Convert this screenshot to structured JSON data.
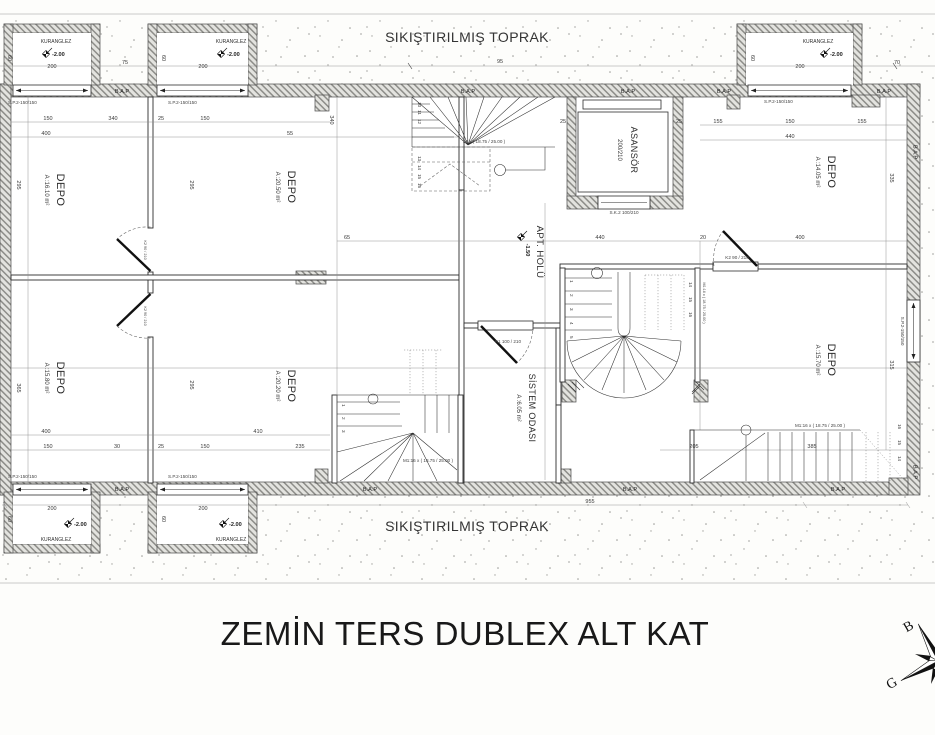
{
  "title": "ZEMİN TERS DUBLEX ALT KAT",
  "soil": {
    "top": "SIKIŞTIRILMIŞ TOPRAK",
    "bottom": "SIKIŞTIRILMIŞ TOPRAK"
  },
  "rooms": {
    "depo1": {
      "name": "DEPO",
      "area": "A :16.10 m²"
    },
    "depo2": {
      "name": "DEPO",
      "area": "A :20.50 m²"
    },
    "depo3": {
      "name": "DEPO",
      "area": "A :14.05 m²"
    },
    "depo4": {
      "name": "DEPO",
      "area": "A :15.80 m²"
    },
    "depo5": {
      "name": "DEPO",
      "area": "A :20.20 m²"
    },
    "depo6": {
      "name": "DEPO",
      "area": "A :15.70 m²"
    },
    "hall": {
      "name": "APT. HOLÜ",
      "level": "-1.50"
    },
    "sistem": {
      "name": "SİSTEM ODASI",
      "area": "A :6.05 m²"
    },
    "asansor": {
      "name": "ASANSÖR",
      "size": "200/210"
    }
  },
  "lightwell": {
    "label": "KURANGLEZ",
    "level": "-2.00"
  },
  "labels": {
    "bap": "B.A.P",
    "window": "S.P.2-150/150",
    "door_k1": "K1 100 / 210",
    "door_k2": "K2 90 / 210",
    "door_sk2": "S.K.2 100/210",
    "stair": "M1:16 x ( 18.75 / 25.00 )",
    "stair_short": "16 x ( 18.75 / 25.00 )"
  },
  "compass": {
    "west": "B",
    "south": "G"
  },
  "dims": [
    "95",
    "150",
    "340",
    "25",
    "150",
    "155",
    "150",
    "155",
    "400",
    "55",
    "440",
    "295",
    "365",
    "335",
    "315",
    "295",
    "295",
    "65",
    "440",
    "20",
    "400",
    "400",
    "410",
    "150",
    "30",
    "25",
    "150",
    "235",
    "205",
    "385",
    "955",
    "200",
    "75",
    "200",
    "200",
    "70",
    "60",
    "60",
    "60",
    "200",
    "200",
    "60",
    "60",
    "25",
    "25",
    "340"
  ],
  "treads": {
    "s1": [
      "10",
      "11",
      "12",
      "13",
      "14",
      "15",
      "16"
    ],
    "s2l": [
      "1",
      "2",
      "3",
      "4",
      "5"
    ],
    "s2r": [
      "14",
      "15",
      "16"
    ],
    "s3": [
      "1",
      "2",
      "3"
    ],
    "s4": [
      "14",
      "15",
      "16"
    ]
  }
}
